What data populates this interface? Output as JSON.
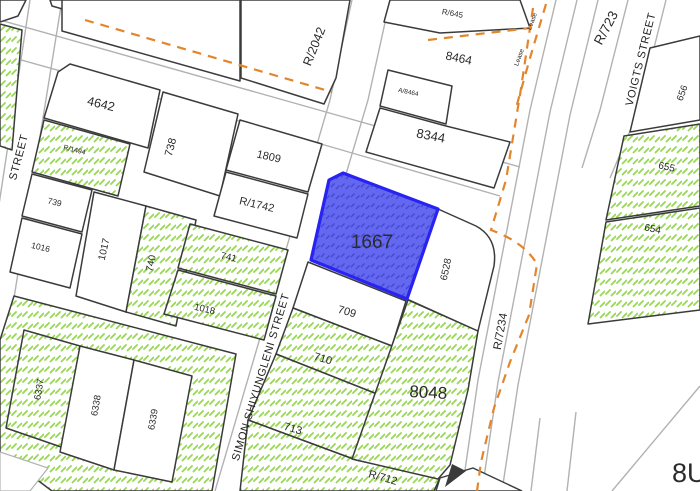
{
  "selected_parcel_id": "1667",
  "streets": {
    "left_street": "STREET",
    "simon": "SIMON SHIYUNGLENI STREET",
    "voigts": "VOIGTS STREET"
  },
  "road_refs": {
    "top_right": "R/723",
    "orange_curve": "R/7234"
  },
  "lease": {
    "label1": "Lease",
    "label2": "Lease"
  },
  "parcels": {
    "p4642": "4642",
    "r1494": "R/1494",
    "p739": "739",
    "p1016": "1016",
    "p1017": "1017",
    "p740": "740",
    "p741": "741",
    "p1018": "1018",
    "p738": "738",
    "p1809": "1809",
    "r1742": "R/1742",
    "r2042": "R/2042",
    "r645": "R/645",
    "p8464": "8464",
    "a8464": "A/8464",
    "p8344": "8344",
    "p6337": "6337",
    "p6338": "6338",
    "p6339": "6339",
    "p1667": "1667",
    "p709": "709",
    "p710": "710",
    "p713": "713",
    "r712": "R/712",
    "p8048": "8048",
    "p6528": "6528",
    "p656": "656",
    "p655": "655",
    "p654": "654",
    "p8u_partial": "8U"
  },
  "colors": {
    "background": "#ffffff",
    "parcel_outline": "#3b3b3b",
    "road_line": "#b2b2b2",
    "green_hatch": "#97d855",
    "selected_fill": "#6467ef",
    "selected_border": "#2822f2",
    "selected_text": "#474a9e",
    "lease_orange": "#e2862d",
    "label_text": "#2b2b2b"
  }
}
